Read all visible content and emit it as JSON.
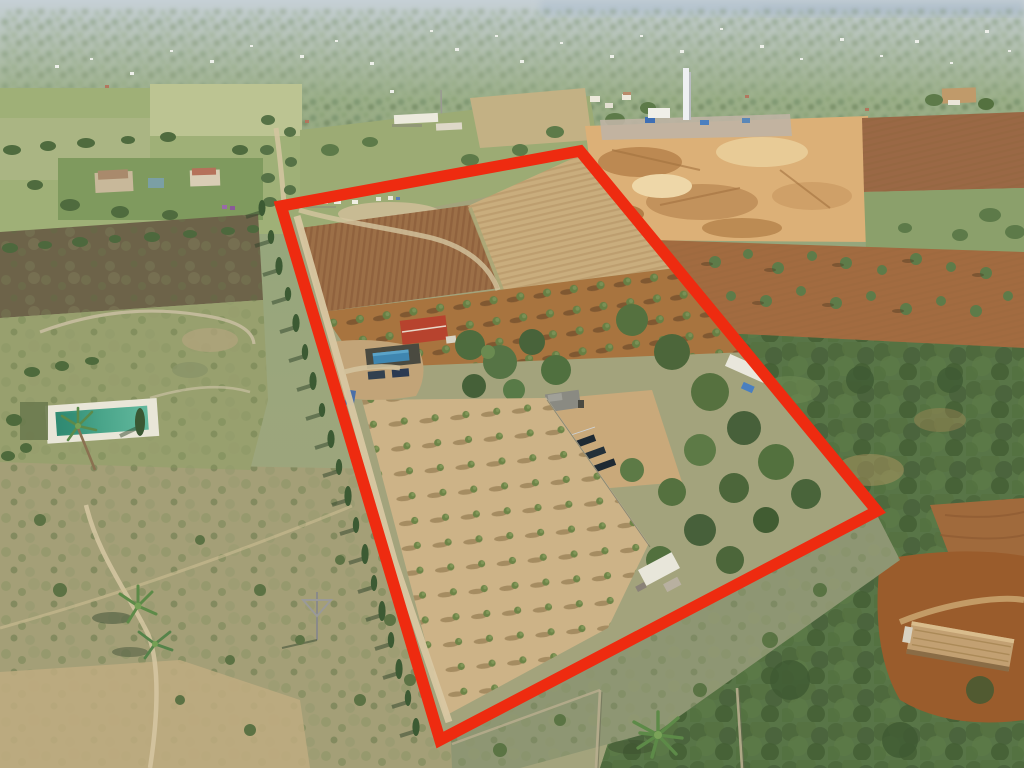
{
  "image": {
    "kind": "aerial-drone-photograph",
    "subject": "rural farmland parcels with one plot highlighted by a red boundary outline",
    "width_px": 1024,
    "height_px": 768,
    "visible_text": ""
  },
  "boundary": {
    "shape": "quadrilateral",
    "points": "281,206 580,151 877,511 440,740",
    "color": "#ee2b10",
    "stroke_width": "11.5"
  },
  "palette": {
    "haze_sky": "#c6d0d6",
    "distant_green": "#93a57c",
    "plowed_brown": "#9c6f47",
    "pale_field": "#c9ad7d",
    "quarry_sand": "#dcb077",
    "woodland_green": "#587547",
    "scrub": "#a49f77",
    "dirt_road": "#d6c5a0",
    "house_roof_red": "#b7432e",
    "garden_pool_teal": "#3e9078",
    "house_pool_blue": "#3f86b0",
    "solar_panel_dark": "#1f2a33"
  },
  "features": [
    {
      "name": "red-boundary-outline",
      "desc": "bright red quadrilateral marking the plot for sale"
    },
    {
      "name": "sand-quarry",
      "desc": "orange sand/gravel pit with piles, machinery and white tower, top right of plot"
    },
    {
      "name": "main-house",
      "desc": "small house with red gable roof inside plot, with pool and parked cars"
    },
    {
      "name": "olive-grove-upper",
      "desc": "rows of olive trees on red-brown soil inside plot"
    },
    {
      "name": "olive-grove-lower",
      "desc": "rows of young olive trees on pale soil inside plot"
    },
    {
      "name": "plowed-fields",
      "desc": "freshly plowed brown fields in upper part of plot"
    },
    {
      "name": "farm-shed-and-solar-panels",
      "desc": "grey-roofed shed and rows of solar panels mid plot"
    },
    {
      "name": "cypress-lined-lane",
      "desc": "dirt lane with cypress row along the left boundary"
    },
    {
      "name": "neighbour-pool-garden",
      "desc": "neighbouring garden with teal swimming pool and palm trees, left"
    },
    {
      "name": "neighbour-farmhouses",
      "desc": "farmhouses with lawns upper left"
    },
    {
      "name": "wild-woodland",
      "desc": "dense green woodland right of the plot"
    },
    {
      "name": "stone-building-bottom-right",
      "desc": "long stone building with tan roof, bottom right"
    },
    {
      "name": "big-palm-tree",
      "desc": "large palm below the bottom boundary corner"
    },
    {
      "name": "distant-town-horizon",
      "desc": "hazy plain with scattered white houses and faint blue hills at top"
    }
  ]
}
